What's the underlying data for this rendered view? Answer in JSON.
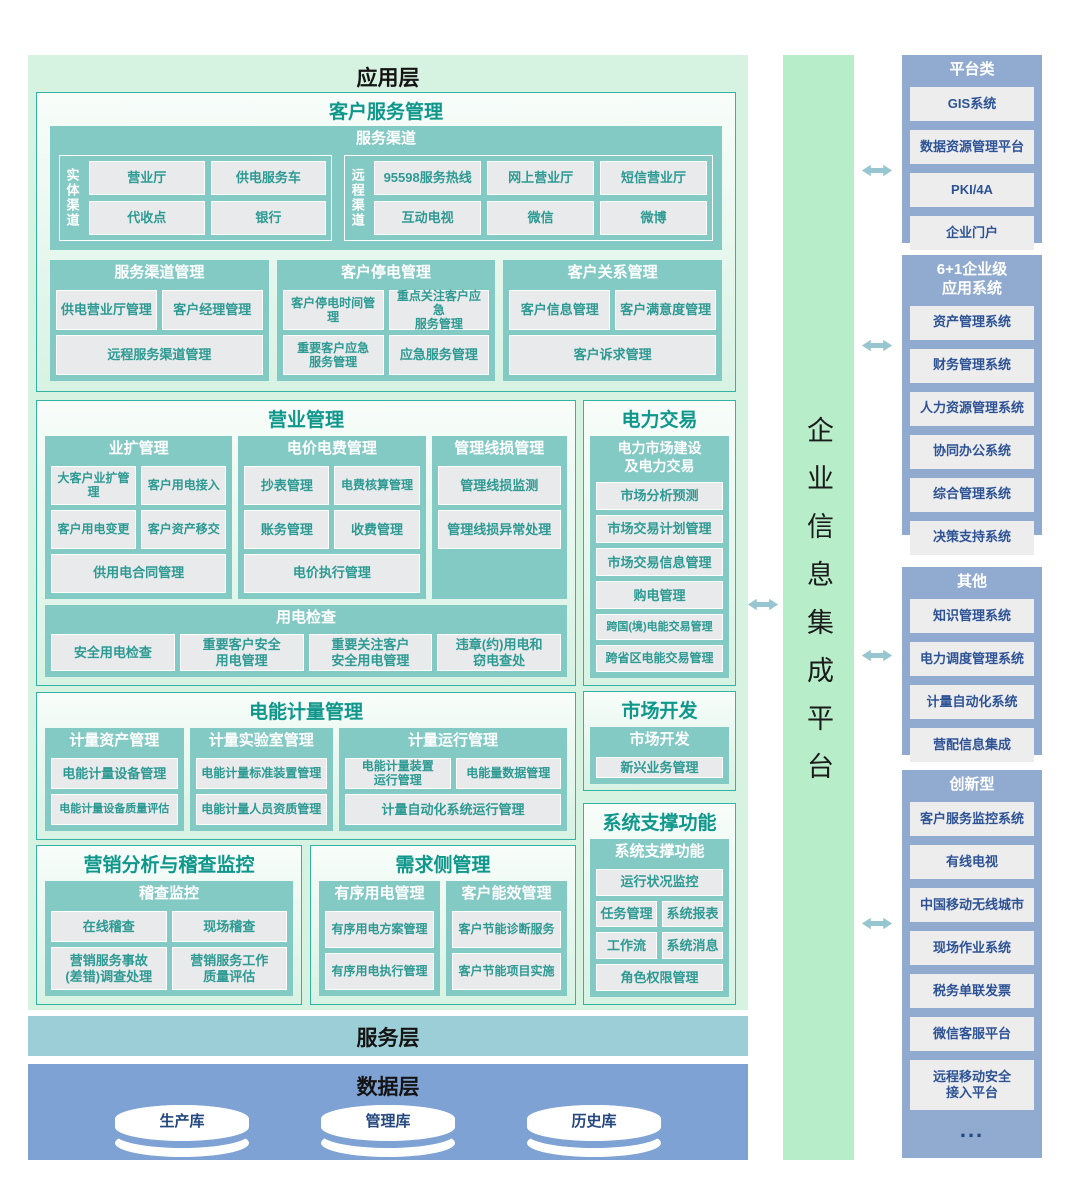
{
  "app": {
    "title": "应用层",
    "customer_service": {
      "title": "客户服务管理",
      "channels": {
        "title": "服务渠道",
        "physical_label": "实体渠道",
        "physical_items": [
          "营业厅",
          "供电服务车",
          "代收点",
          "银行"
        ],
        "remote_label": "远程渠道",
        "remote_items": [
          "95598服务热线",
          "网上营业厅",
          "短信营业厅",
          "互动电视",
          "微信",
          "微博"
        ]
      },
      "channel_mgmt": {
        "title": "服务渠道管理",
        "items": [
          "供电营业厅管理",
          "客户经理管理",
          "远程服务渠道管理"
        ]
      },
      "outage_mgmt": {
        "title": "客户停电管理",
        "items": [
          "客户停电时间管理",
          "重点关注客户应急\n服务管理",
          "重要客户应急\n服务管理",
          "应急服务管理"
        ]
      },
      "crm": {
        "title": "客户关系管理",
        "items": [
          "客户信息管理",
          "客户满意度管理",
          "客户诉求管理"
        ]
      }
    },
    "business": {
      "title": "营业管理",
      "expansion": {
        "title": "业扩管理",
        "items": [
          "大客户业扩管理",
          "客户用电接入",
          "客户用电变更",
          "客户资产移交",
          "供用电合同管理"
        ]
      },
      "tariff": {
        "title": "电价电费管理",
        "items": [
          "抄表管理",
          "电费核算管理",
          "账务管理",
          "收费管理",
          "电价执行管理"
        ]
      },
      "line_loss": {
        "title": "管理线损管理",
        "items": [
          "管理线损监测",
          "管理线损异常处理"
        ]
      },
      "inspection": {
        "title": "用电检查",
        "items": [
          "安全用电检查",
          "重要客户安全\n用电管理",
          "重要关注客户\n安全用电管理",
          "违章(约)用电和\n窃电查处"
        ]
      }
    },
    "trading": {
      "title": "电力交易",
      "sub": "电力市场建设\n及电力交易",
      "items": [
        "市场分析预测",
        "市场交易计划管理",
        "市场交易信息管理",
        "购电管理",
        "跨国(境)电能交易管理",
        "跨省区电能交易管理"
      ]
    },
    "metering": {
      "title": "电能计量管理",
      "asset": {
        "title": "计量资产管理",
        "items": [
          "电能计量设备管理",
          "电能计量设备质量评估"
        ]
      },
      "lab": {
        "title": "计量实验室管理",
        "items": [
          "电能计量标准装置管理",
          "电能计量人员资质管理"
        ]
      },
      "operation": {
        "title": "计量运行管理",
        "items": [
          "电能计量装置\n运行管理",
          "电能量数据管理",
          "计量自动化系统运行管理"
        ]
      }
    },
    "market_dev": {
      "title": "市场开发",
      "sub": "市场开发",
      "items": [
        "新兴业务管理"
      ]
    },
    "sys_support": {
      "title": "系统支撑功能",
      "sub": "系统支撑功能",
      "items": [
        "运行状况监控",
        "任务管理",
        "系统报表",
        "工作流",
        "系统消息",
        "角色权限管理"
      ]
    },
    "audit": {
      "title": "营销分析与稽查监控",
      "sub": "稽查监控",
      "items": [
        "在线稽查",
        "现场稽查",
        "营销服务事故\n(差错)调查处理",
        "营销服务工作\n质量评估"
      ]
    },
    "demand": {
      "title": "需求侧管理",
      "orderly": {
        "title": "有序用电管理",
        "items": [
          "有序用电方案管理",
          "有序用电执行管理"
        ]
      },
      "efficiency": {
        "title": "客户能效管理",
        "items": [
          "客户节能诊断服务",
          "客户节能项目实施"
        ]
      }
    }
  },
  "service_layer": {
    "title": "服务层"
  },
  "data_layer": {
    "title": "数据层",
    "databases": [
      "生产库",
      "管理库",
      "历史库"
    ]
  },
  "platform": {
    "title": "企业信息集成平台"
  },
  "right": {
    "platform_class": {
      "title": "平台类",
      "items": [
        "GIS系统",
        "数据资源管理平台",
        "PKI/4A",
        "企业门户"
      ]
    },
    "enterprise": {
      "title": "6+1企业级\n应用系统",
      "items": [
        "资产管理系统",
        "财务管理系统",
        "人力资源管理系统",
        "协同办公系统",
        "综合管理系统",
        "决策支持系统"
      ]
    },
    "others": {
      "title": "其他",
      "items": [
        "知识管理系统",
        "电力调度管理系统",
        "计量自动化系统",
        "营配信息集成"
      ]
    },
    "innovative": {
      "title": "创新型",
      "items": [
        "客户服务监控系统",
        "有线电视",
        "中国移动无线城市",
        "现场作业系统",
        "税务单联发票",
        "微信客服平台",
        "远程移动安全\n接入平台"
      ],
      "more": "..."
    }
  },
  "colors": {
    "app_bg": "#d6f2e0",
    "teal_block": "#83c9c4",
    "item_text_teal": "#2d9a93",
    "section_title_teal": "#0f978c",
    "service_bar": "#9bced6",
    "data_bar": "#7ea2d4",
    "platform_bar": "#b8edca",
    "right_panel_bg": "#91aacf",
    "right_item_text": "#2e5395",
    "arrow": "#98c6d0"
  }
}
